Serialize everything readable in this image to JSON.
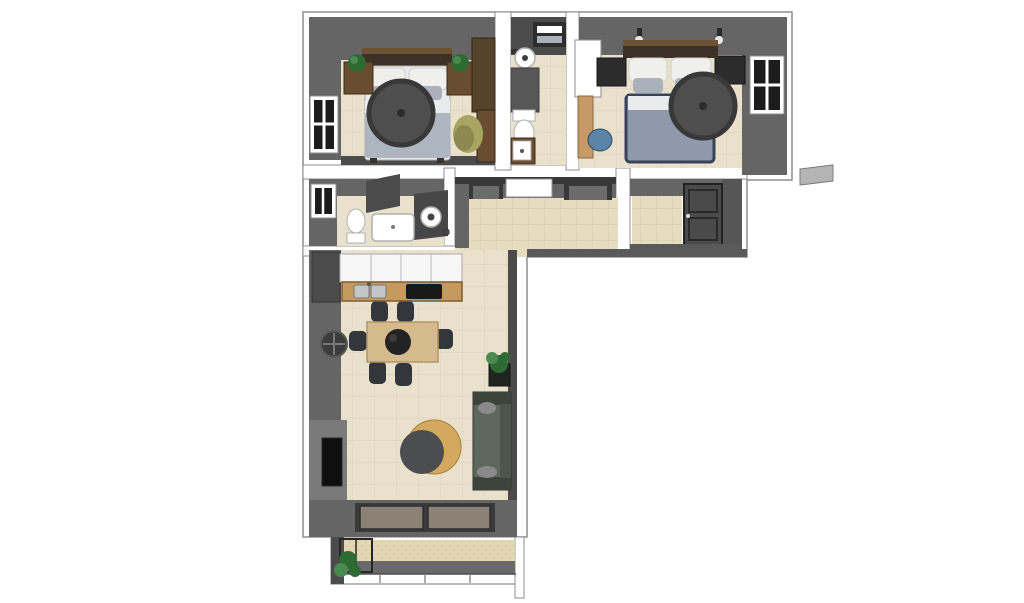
{
  "scene": {
    "type": "floor-plan-3d-render",
    "view": "top-down axonometric",
    "background": "#ffffff"
  },
  "colors": {
    "background": "#ffffff",
    "outline": "#8d8d8d",
    "wall_cut": "#ffffff",
    "wall_face": "#656565",
    "wall_face_dark": "#4b4b4b",
    "wall_face_light": "#7a7a7a",
    "wall_lintel": "#383838",
    "floor": "#eae1cc",
    "hall_floor": "#e7dcbf",
    "balcony_floor": "#e3d6b4",
    "window_frame": "#ffffff",
    "window_pane": "#1c1c1c",
    "bed1_duvet": "#adb5c0",
    "bed2_duvet": "#8e99ab",
    "bed2_trim": "#37425c",
    "pillow_white": "#efefec",
    "pillow_gray": "#aab1bb",
    "sheet_white": "#e9ebec",
    "headboard_dark": "#3c3127",
    "headboard_trim": "#6b5233",
    "wood_brown": "#6a4c31",
    "wood_dark": "#57422b",
    "fan": "#4e4e4e",
    "fan_ring": "#383838",
    "plant_green": "#2e6b33",
    "plant_light": "#4b8a4f",
    "plant_pot": "#20261f",
    "olive_chair": "#a8a562",
    "olive_chair_dark": "#8b894e",
    "fixture_white": "#ffffff",
    "fixture_stroke": "#b0b0b0",
    "counter_gray": "#575757",
    "shelf_dark": "#2d2d2d",
    "cabinet_white": "#f6f6f6",
    "counter_wood": "#c49a5e",
    "sink_steel": "#c3c6c8",
    "cooktop_black": "#191919",
    "desk_wood": "#c59a66",
    "chair_blue": "#5b84a8",
    "nightstand_dark": "#2c2c2c",
    "door_white": "#ffffff",
    "door_dark": "#4a4a4a",
    "table_wood": "#d4ba8d",
    "chair_dark": "#33363b",
    "tray_dark": "#232323",
    "sofa_green": "#5d675c",
    "sofa_dark": "#3c443c",
    "cat_gray": "#8a8a8a",
    "armchair_tan": "#d3a95f",
    "cushion_dark": "#4b4d50",
    "glass_taupe": "#8b8275",
    "frame_dark": "#3a3a3a",
    "tv_black": "#0f0f0f",
    "railing_gray": "#6a6a6a",
    "ac_gray": "#b5b5b5"
  },
  "rooms": [
    {
      "id": "bedroom-1",
      "label": "Bedroom 1",
      "furniture": [
        "double-bed",
        "ceiling-fan",
        "nightstand-left",
        "nightstand-right",
        "potted-plant-left",
        "potted-plant-right",
        "wardrobe",
        "window-west",
        "accent-chair"
      ]
    },
    {
      "id": "bathroom-1",
      "label": "Bathroom 1",
      "furniture": [
        "towel-shelf",
        "round-sink",
        "vanity-counter",
        "toilet",
        "sink-cabinet"
      ]
    },
    {
      "id": "bedroom-2",
      "label": "Bedroom 2",
      "furniture": [
        "double-bed",
        "ceiling-fan",
        "nightstand-left",
        "nightstand-right",
        "wall-sconce-left",
        "wall-sconce-right",
        "open-door",
        "desk",
        "desk-chair",
        "window-east"
      ]
    },
    {
      "id": "bathroom-2",
      "label": "Bathroom 2",
      "furniture": [
        "window-west",
        "toilet",
        "bathtub",
        "washing-machine",
        "shower-partitions"
      ]
    },
    {
      "id": "kitchen",
      "label": "Kitchen",
      "furniture": [
        "tall-cabinet",
        "upper-cabinets",
        "counter",
        "double-sink",
        "cooktop"
      ]
    },
    {
      "id": "hallway",
      "label": "Hallway",
      "furniture": [
        "door-frame-west",
        "open-doorway",
        "door-frame-east"
      ]
    },
    {
      "id": "entry",
      "label": "Entry",
      "furniture": [
        "front-door"
      ]
    },
    {
      "id": "living-dining",
      "label": "Living / Dining Room",
      "furniture": [
        "dining-table",
        "dining-chairs-x6",
        "center-tray",
        "wall-fan",
        "tv-niche",
        "potted-plant",
        "sofa",
        "cats-x2",
        "armchair",
        "sliding-glass-door"
      ]
    },
    {
      "id": "balcony",
      "label": "Balcony",
      "furniture": [
        "plant-trellis",
        "railing"
      ]
    }
  ],
  "exterior": {
    "items": [
      "ac-unit"
    ]
  }
}
